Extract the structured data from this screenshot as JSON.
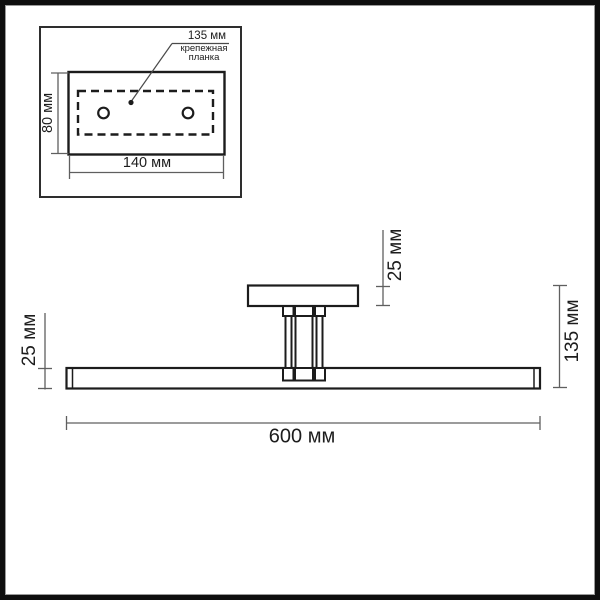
{
  "title": "wall-lamp dimension drawing",
  "inset": {
    "plank_width_label": "135 мм",
    "plank_name": "крепежная планка",
    "plate_height_label": "80 мм",
    "plate_width_label": "140 мм"
  },
  "main": {
    "bar_thickness_label": "25 мм",
    "canopy_height_label": "25 мм",
    "overall_height_label": "135 мм",
    "overall_length_label": "600 мм"
  },
  "colors": {
    "outline": "#1c1c1c",
    "dimension_line": "#5f5f5f",
    "text": "#1d1d1d",
    "page_frame": "#0e0e0e",
    "background": "#ffffff"
  }
}
